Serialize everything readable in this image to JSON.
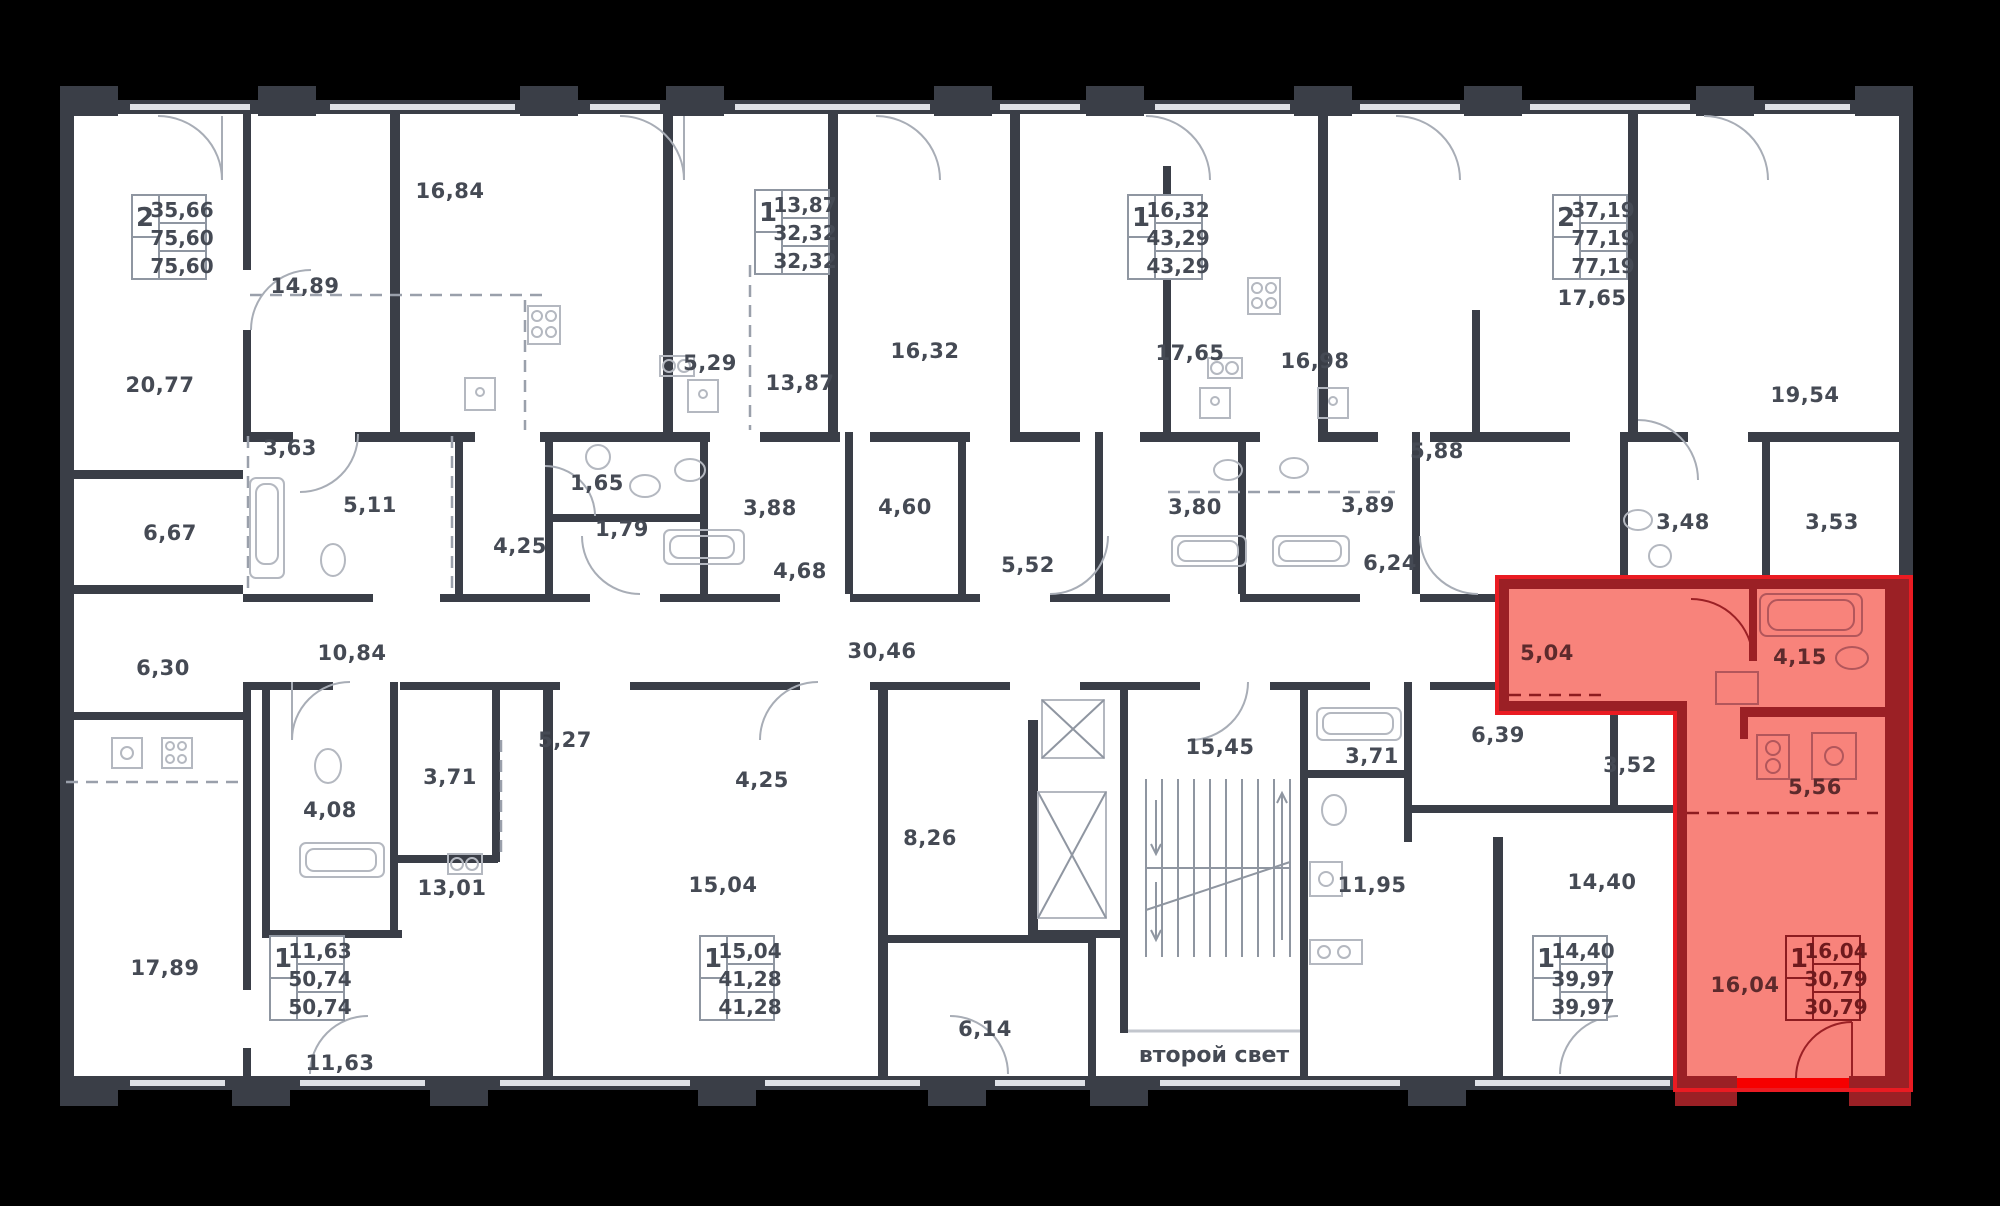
{
  "scene": {
    "type": "building-floor-plan",
    "highlighted_unit_index": 7
  },
  "colors": {
    "background": "#000000",
    "floor": "#ffffff",
    "wall": "#3a3e47",
    "label_text": "#454a54",
    "highlight_fill": "#f8837b",
    "highlight_wall": "#9b2025",
    "highlight_outline": "#ea1b22",
    "balcony_strip": "#f60000"
  },
  "units": [
    {
      "rooms": "2",
      "value1": "35,66",
      "value2": "75,60",
      "value3": "75,60",
      "highlighted": false
    },
    {
      "rooms": "1",
      "value1": "13,87",
      "value2": "32,32",
      "value3": "32,32",
      "highlighted": false
    },
    {
      "rooms": "1",
      "value1": "16,32",
      "value2": "43,29",
      "value3": "43,29",
      "highlighted": false
    },
    {
      "rooms": "2",
      "value1": "37,19",
      "value2": "77,19",
      "value3": "77,19",
      "highlighted": false
    },
    {
      "rooms": "1",
      "value1": "11,63",
      "value2": "50,74",
      "value3": "50,74",
      "highlighted": false
    },
    {
      "rooms": "1",
      "value1": "15,04",
      "value2": "41,28",
      "value3": "41,28",
      "highlighted": false
    },
    {
      "rooms": "1",
      "value1": "14,40",
      "value2": "39,97",
      "value3": "39,97",
      "highlighted": false
    },
    {
      "rooms": "1",
      "value1": "16,04",
      "value2": "30,79",
      "value3": "30,79",
      "highlighted": true
    }
  ],
  "room_areas": [
    "20,77",
    "14,89",
    "16,84",
    "5,29",
    "13,87",
    "16,32",
    "17,65",
    "16,98",
    "17,65",
    "19,54",
    "3,63",
    "6,67",
    "5,11",
    "1,65",
    "1,79",
    "4,25",
    "3,88",
    "4,68",
    "4,60",
    "5,52",
    "3,80",
    "3,89",
    "5,88",
    "6,24",
    "3,48",
    "3,53",
    "6,30",
    "10,84",
    "30,46",
    "5,04",
    "4,15",
    "5,27",
    "3,71",
    "4,25",
    "15,45",
    "3,71",
    "6,39",
    "3,52",
    "5,56",
    "4,08",
    "8,26",
    "13,01",
    "15,04",
    "11,95",
    "14,40",
    "17,89",
    "16,04",
    "6,14",
    "11,63"
  ],
  "stairwell": {
    "second_light_label": "второй свет"
  }
}
